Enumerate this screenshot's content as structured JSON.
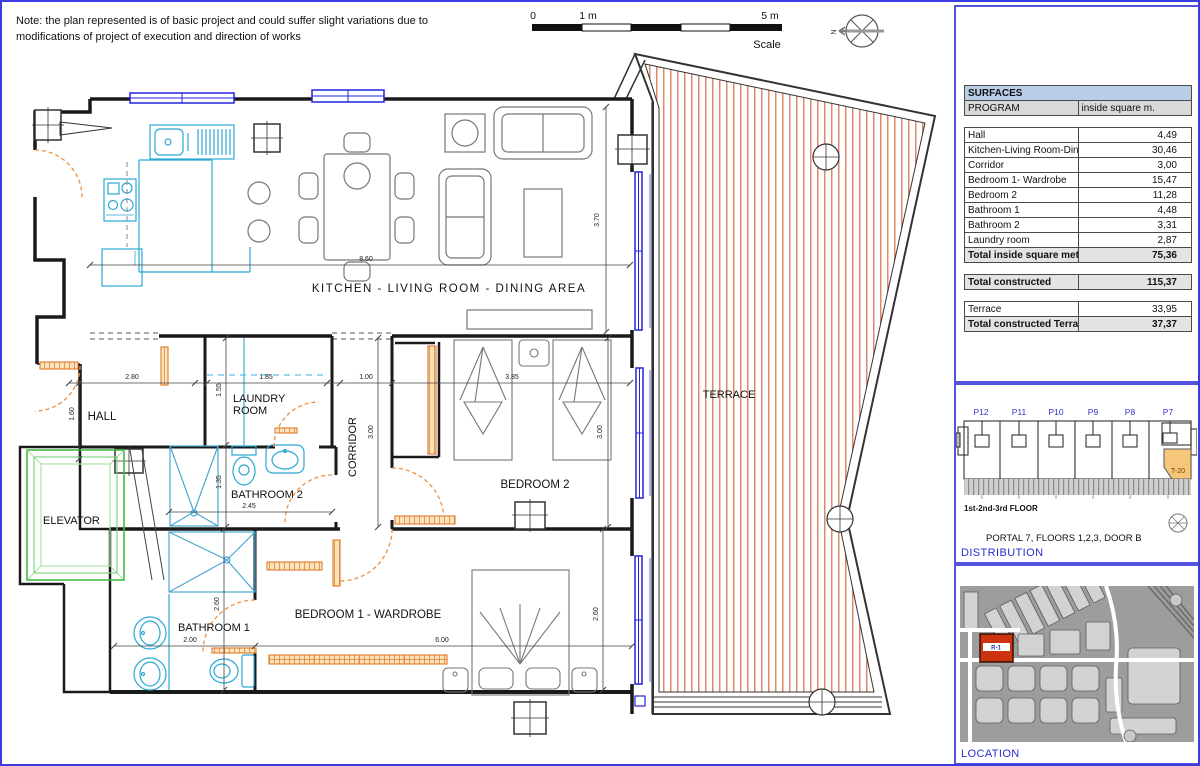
{
  "sheet": {
    "note_line1": "Note: the plan represented is of basic project and could suffer slight variations due to",
    "note_line2": "modifications of project of execution and direction of works",
    "scale": {
      "tick0": "0",
      "tick1": "1 m",
      "tick5": "5 m",
      "label": "Scale"
    },
    "north": "N"
  },
  "plan": {
    "rooms": {
      "kitchen_living": "KITCHEN - LIVING ROOM - DINING AREA",
      "hall": "HALL",
      "laundry_line1": "LAUNDRY",
      "laundry_line2": "ROOM",
      "corridor": "CORRIDOR",
      "bathroom2": "BATHROOM 2",
      "bedroom2": "BEDROOM 2",
      "elevator": "ELEVATOR",
      "bathroom1": "BATHROOM 1",
      "bedroom1": "BEDROOM 1 - WARDROBE",
      "terrace": "TERRACE"
    },
    "dims": {
      "living_w": "8.60",
      "living_h": "3.70",
      "hall_w": "2.80",
      "hall_h": "1.60",
      "laundry_w": "1.85",
      "laundry_h": "1.55",
      "corridor_w": "1.00",
      "corridor_h": "3.00",
      "bedroom2_w": "3.85",
      "bedroom2_h": "3.00",
      "bathroom2_w": "2.45",
      "bathroom2_h": "1.35",
      "bathroom1_w": "2.00",
      "bathroom1_h": "2.60",
      "bedroom1_w": "6.00",
      "bedroom1_h": "2.60"
    }
  },
  "surfaces": {
    "title": "SURFACES",
    "col_program": "PROGRAM",
    "col_value": "inside square m.",
    "rows": [
      {
        "style": "spacer",
        "label": "",
        "value": ""
      },
      {
        "style": "row",
        "label": "Hall",
        "value": "4,49"
      },
      {
        "style": "row",
        "label": "Kitchen-Living Room-Dining area",
        "value": "30,46"
      },
      {
        "style": "row",
        "label": "Corridor",
        "value": "3,00"
      },
      {
        "style": "row",
        "label": "Bedroom 1- Wardrobe",
        "value": "15,47"
      },
      {
        "style": "row",
        "label": "Bedroom 2",
        "value": "11,28"
      },
      {
        "style": "row",
        "label": "Bathroom 1",
        "value": "4,48"
      },
      {
        "style": "row",
        "label": "Bathroom 2",
        "value": "3,31"
      },
      {
        "style": "row",
        "label": "Laundry room",
        "value": "2,87"
      },
      {
        "style": "total",
        "label": "Total inside square meter",
        "value": "75,36"
      },
      {
        "style": "spacer",
        "label": "",
        "value": ""
      },
      {
        "style": "total",
        "label": "Total constructed",
        "value": "115,37"
      },
      {
        "style": "spacer",
        "label": "",
        "value": ""
      },
      {
        "style": "row",
        "label": "Terrace",
        "value": "33,95"
      },
      {
        "style": "total",
        "label": "Total constructed Terraces",
        "value": "37,37"
      }
    ]
  },
  "distribution": {
    "portals": [
      "P12",
      "P11",
      "P10",
      "P9",
      "P8",
      "P7"
    ],
    "unit_label": "T-20",
    "floors_note": "1st-2nd-3rd FLOOR",
    "caption": "PORTAL 7, FLOORS 1,2,3, DOOR B",
    "title": "DISTRIBUTION"
  },
  "location": {
    "marker": "R-1",
    "title": "LOCATION"
  },
  "colors": {
    "wall": "#1a1a1a",
    "window_blue": "#2323dd",
    "fixture_cyan": "#2ba7d4",
    "door_orange": "#ee8f3f",
    "terrace_stripe": "#dd8868",
    "elevator_green": "#4cc24c",
    "panel_border": "#5353dd",
    "table_header_fill": "#b9cde8",
    "accent_blue_text": "#2b2bd0",
    "marker_red": "#cc3311"
  }
}
